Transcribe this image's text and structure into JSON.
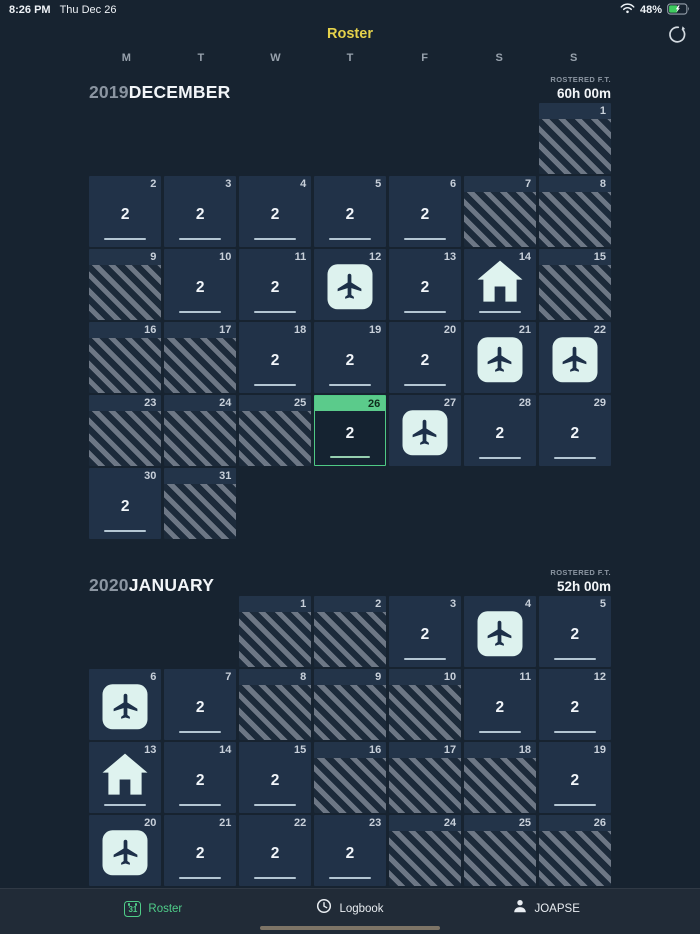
{
  "status_bar": {
    "time": "8:26 PM",
    "date": "Thu Dec 26",
    "battery_percent": "48%",
    "battery_charging": true,
    "icons": [
      "wifi-icon",
      "battery-icon"
    ]
  },
  "nav": {
    "title": "Roster",
    "refresh_icon": "refresh-icon"
  },
  "weekdays": [
    "M",
    "T",
    "W",
    "T",
    "F",
    "S",
    "S"
  ],
  "months": [
    {
      "year": "2019",
      "name": "DECEMBER",
      "rostered_label": "ROSTERED F.T.",
      "rostered_value": "60h 00m",
      "start_col": 7,
      "days": [
        {
          "day": 1,
          "type": "off"
        },
        {
          "day": 2,
          "type": "duty",
          "value": "2"
        },
        {
          "day": 3,
          "type": "duty",
          "value": "2"
        },
        {
          "day": 4,
          "type": "duty",
          "value": "2"
        },
        {
          "day": 5,
          "type": "duty",
          "value": "2"
        },
        {
          "day": 6,
          "type": "duty",
          "value": "2"
        },
        {
          "day": 7,
          "type": "off"
        },
        {
          "day": 8,
          "type": "off"
        },
        {
          "day": 9,
          "type": "off"
        },
        {
          "day": 10,
          "type": "duty",
          "value": "2"
        },
        {
          "day": 11,
          "type": "duty",
          "value": "2"
        },
        {
          "day": 12,
          "type": "flight"
        },
        {
          "day": 13,
          "type": "duty",
          "value": "2"
        },
        {
          "day": 14,
          "type": "home"
        },
        {
          "day": 15,
          "type": "off"
        },
        {
          "day": 16,
          "type": "off"
        },
        {
          "day": 17,
          "type": "off"
        },
        {
          "day": 18,
          "type": "duty",
          "value": "2"
        },
        {
          "day": 19,
          "type": "duty",
          "value": "2"
        },
        {
          "day": 20,
          "type": "duty",
          "value": "2"
        },
        {
          "day": 21,
          "type": "flight"
        },
        {
          "day": 22,
          "type": "flight"
        },
        {
          "day": 23,
          "type": "off"
        },
        {
          "day": 24,
          "type": "off"
        },
        {
          "day": 25,
          "type": "off"
        },
        {
          "day": 26,
          "type": "duty",
          "value": "2",
          "today": true
        },
        {
          "day": 27,
          "type": "flight"
        },
        {
          "day": 28,
          "type": "duty",
          "value": "2"
        },
        {
          "day": 29,
          "type": "duty",
          "value": "2"
        },
        {
          "day": 30,
          "type": "duty",
          "value": "2"
        },
        {
          "day": 31,
          "type": "off"
        }
      ]
    },
    {
      "year": "2020",
      "name": "JANUARY",
      "rostered_label": "ROSTERED F.T.",
      "rostered_value": "52h 00m",
      "start_col": 3,
      "days": [
        {
          "day": 1,
          "type": "off"
        },
        {
          "day": 2,
          "type": "off"
        },
        {
          "day": 3,
          "type": "duty",
          "value": "2"
        },
        {
          "day": 4,
          "type": "flight"
        },
        {
          "day": 5,
          "type": "duty",
          "value": "2"
        },
        {
          "day": 6,
          "type": "flight"
        },
        {
          "day": 7,
          "type": "duty",
          "value": "2"
        },
        {
          "day": 8,
          "type": "off"
        },
        {
          "day": 9,
          "type": "off"
        },
        {
          "day": 10,
          "type": "off"
        },
        {
          "day": 11,
          "type": "duty",
          "value": "2"
        },
        {
          "day": 12,
          "type": "duty",
          "value": "2"
        },
        {
          "day": 13,
          "type": "home"
        },
        {
          "day": 14,
          "type": "duty",
          "value": "2"
        },
        {
          "day": 15,
          "type": "duty",
          "value": "2"
        },
        {
          "day": 16,
          "type": "off"
        },
        {
          "day": 17,
          "type": "off"
        },
        {
          "day": 18,
          "type": "off"
        },
        {
          "day": 19,
          "type": "duty",
          "value": "2"
        },
        {
          "day": 20,
          "type": "flight"
        },
        {
          "day": 21,
          "type": "duty",
          "value": "2"
        },
        {
          "day": 22,
          "type": "duty",
          "value": "2"
        },
        {
          "day": 23,
          "type": "duty",
          "value": "2"
        },
        {
          "day": 24,
          "type": "off"
        },
        {
          "day": 25,
          "type": "off"
        },
        {
          "day": 26,
          "type": "off"
        }
      ]
    }
  ],
  "day_type_icons": {
    "off": "diagonal-stripes",
    "flight": "airplane-icon",
    "home": "home-icon"
  },
  "tab_bar": {
    "tabs": [
      {
        "label": "Roster",
        "icon": "calendar-31-icon",
        "active": true,
        "calendar_number": "31"
      },
      {
        "label": "Logbook",
        "icon": "clock-icon",
        "active": false
      },
      {
        "label": "JOAPSE",
        "icon": "person-icon",
        "active": false
      }
    ]
  },
  "colors": {
    "accent_yellow": "#e5d24b",
    "accent_green": "#4fcd89",
    "today_green": "#5bcb8b",
    "icon_mint": "#ddf2ee",
    "cell_bg": "#213248",
    "off_stripe": "#6d7785"
  }
}
